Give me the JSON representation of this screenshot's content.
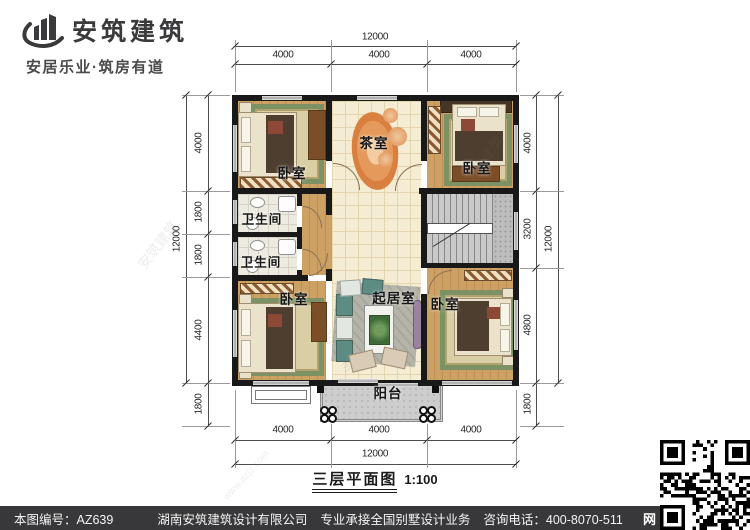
{
  "brand": {
    "name": "安筑建筑",
    "slogan": "安居乐业·筑房有道"
  },
  "plan": {
    "title": "三层平面图",
    "scale": "1:100",
    "rooms": {
      "bedroom_top_left": "卧室",
      "bedroom_top_right": "卧室",
      "bedroom_bottom_left": "卧室",
      "bedroom_bottom_right": "卧室",
      "tea_room": "茶室",
      "bathroom_upper": "卫生间",
      "bathroom_lower": "卫生间",
      "living_room": "起居室",
      "balcony": "阳台"
    },
    "dimensions": {
      "top": {
        "overall": "12000",
        "segments": [
          "4000",
          "4000",
          "4000"
        ]
      },
      "bottom": {
        "overall": "12000",
        "segments": [
          "4000",
          "4000",
          "4000"
        ]
      },
      "left": {
        "overall": "12000",
        "segments": [
          "4000",
          "1800",
          "1800",
          "4400",
          "1800"
        ]
      },
      "right": {
        "overall": "12000",
        "segments": [
          "4000",
          "3200",
          "4800",
          "1800"
        ]
      }
    }
  },
  "watermark": {
    "brand": "安筑建筑",
    "url": "www.azjz.com"
  },
  "footer": {
    "drawing_no": "本图编号：AZ639",
    "company": "湖南安筑建筑设计有限公司",
    "service": "专业承接全国别墅设计业务",
    "phone": "咨询电话：400-8070-511",
    "web_badge": "网"
  },
  "colors": {
    "bar": "#38383a",
    "wall": "#191919",
    "wood": "#cda164",
    "tile": "#f5ecd4",
    "stair": "#c6c6c6",
    "rug_green": "#7d9264",
    "tea_rug_orange": "#e08c50"
  }
}
